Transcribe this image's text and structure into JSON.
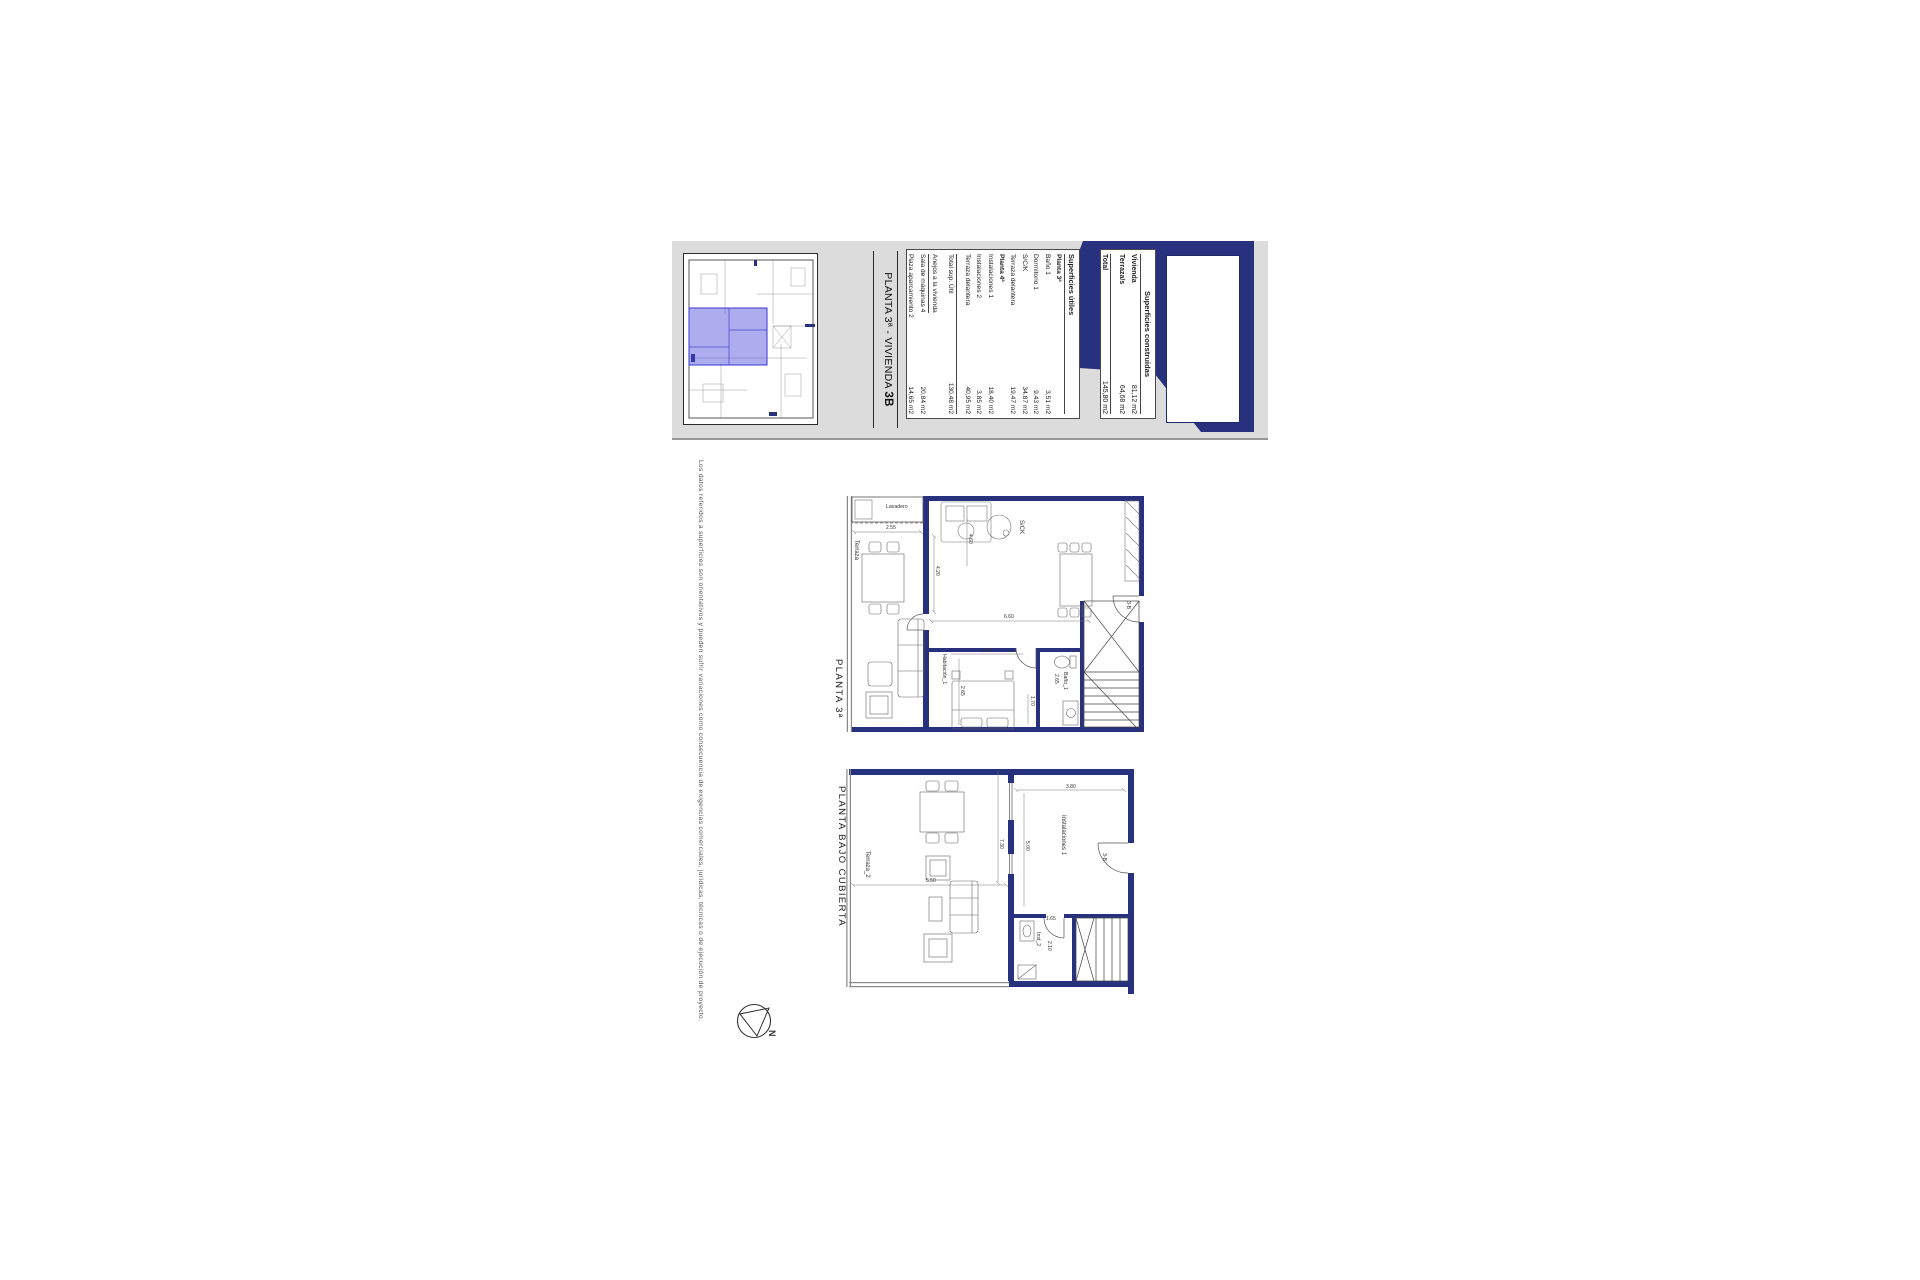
{
  "colors": {
    "wall_navy": "#28317e",
    "highlight_blue": "rgba(70,70,220,0.45)",
    "panel_gray": "#dcdcdc"
  },
  "title_block": {
    "title": {
      "prefix": "PLANTA 3ª - VIVIENDA ",
      "unit": "3B"
    },
    "construidas": {
      "header": "Superficies construidas",
      "rows": [
        {
          "label": "Vivienda",
          "value": "81,12 m2"
        },
        {
          "label": "Terraza/s",
          "value": "64,68 m2"
        },
        {
          "label": "Total",
          "value": "145,80 m2"
        }
      ]
    },
    "utiles": {
      "header": "Superficies útiles",
      "rows": [
        {
          "label": "Planta 3ª",
          "value": ""
        },
        {
          "label": "Baño 1",
          "value": "3,51 m2"
        },
        {
          "label": "Dormitorio 1",
          "value": "9,43 m2"
        },
        {
          "label": "S/C/K",
          "value": "34,87 m2"
        },
        {
          "label": "Terraza delantera",
          "value": "19,47 m2"
        },
        {
          "label": "Planta 4ª",
          "value": ""
        },
        {
          "label": "Instalaciones 1",
          "value": "18,40 m2"
        },
        {
          "label": "Instalaciones 2",
          "value": "3,85 m2"
        },
        {
          "label": "Terraza delantera",
          "value": "40,95 m2"
        },
        {
          "label": "Total sup. Útil",
          "value": "130,48 m2"
        },
        {
          "label": "Anejos a la vivienda",
          "value": ""
        },
        {
          "label": "Sala de máquinas 4",
          "value": "20,84 m2"
        },
        {
          "label": "Plaza aparcamiento 2",
          "value": "14,65 m2"
        }
      ]
    }
  },
  "plans": {
    "planta3": {
      "label": "PLANTA 3ª",
      "rooms": {
        "lavadero": "Lavadero",
        "terraza": "Terraza",
        "sck": "S/CK",
        "bedroom": "Habitación_1",
        "bath": "Baño_1",
        "door": "3-B"
      },
      "dims": {
        "terrace_width": "2.55",
        "living_width": "4.20",
        "kitchen_width": "4.60",
        "depth": "6.60",
        "bedroom_width": "3.45",
        "bedroom_depth": "2.65",
        "bath_width": "2.65",
        "stair_width": "1.70"
      }
    },
    "bajo_cubierta": {
      "label": "PLANTA BAJO CUBIERTA",
      "rooms": {
        "terraza": "Terraza_2",
        "inst1": "Instalaciones 1",
        "inst2": "Inst_2",
        "door": "3-B"
      },
      "dims": {
        "inst_width": "3.80",
        "inst_depth": "5.00",
        "terrace_span": "7.30",
        "terrace_width": "5.50",
        "inst2_width": "1.65",
        "inst2_depth": "2.10"
      }
    }
  },
  "compass": {
    "label": "N"
  },
  "disclaimer": "Los datos referidos a superficies son orientativos y pueden sufrir variaciones como consecuencia de exigencias comerciales, jurídicas, técnicas o de ejecución de proyecto."
}
